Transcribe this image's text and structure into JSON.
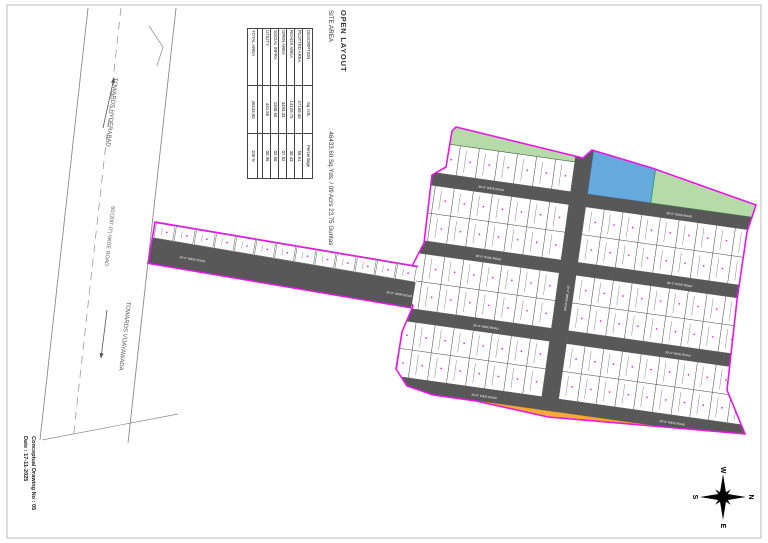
{
  "drawing": {
    "title": "OPEN LAYOUT",
    "site_area_label": "SITE AREA",
    "site_area_value": ": 46433.60 Sq.Yds. / 09 Acrs 23.75 Guntas"
  },
  "area_table": {
    "headers": [
      "DESCRIPTION",
      "Sq.Yds.",
      "Percentage"
    ],
    "rows": [
      [
        "PLOTTED AREA",
        "27169.30",
        "58.51"
      ],
      [
        "ROADS AREA",
        "14129.75",
        "30.43"
      ],
      [
        "OPEN AREA",
        "3493.33",
        "07.52"
      ],
      [
        "SOCIAL INFRA",
        "1200.65",
        "02.58"
      ],
      [
        "UTILITY",
        "441.55",
        "00.96"
      ]
    ],
    "total": [
      "TOTAL AREA",
      "46433.60",
      "100 %"
    ]
  },
  "highway": {
    "towards_top": "TOWARDS HYDERABAD",
    "towards_bottom": "TOWARDS VIJAYAWADA",
    "name": "60'(200'-0\") WIDE ROAD"
  },
  "roads": {
    "internal_label": "30'-0\" WIDE ROAD"
  },
  "footer": {
    "line1": "Conceptual Drawing No : 05",
    "line2": "Date : 17-11-2025"
  },
  "compass": {
    "top": "W",
    "right": "N",
    "bottom": "E",
    "left": "S"
  },
  "colors": {
    "boundary": "#e816e8",
    "road": "#585858",
    "open_area": "#b7daa9",
    "open_area_border": "#35a04a",
    "social_infra": "#66a9dd",
    "social_infra_border": "#3c7ebf",
    "utility": "#f3a93c",
    "utility_border": "#c77f00",
    "plot": "#ffffff"
  }
}
